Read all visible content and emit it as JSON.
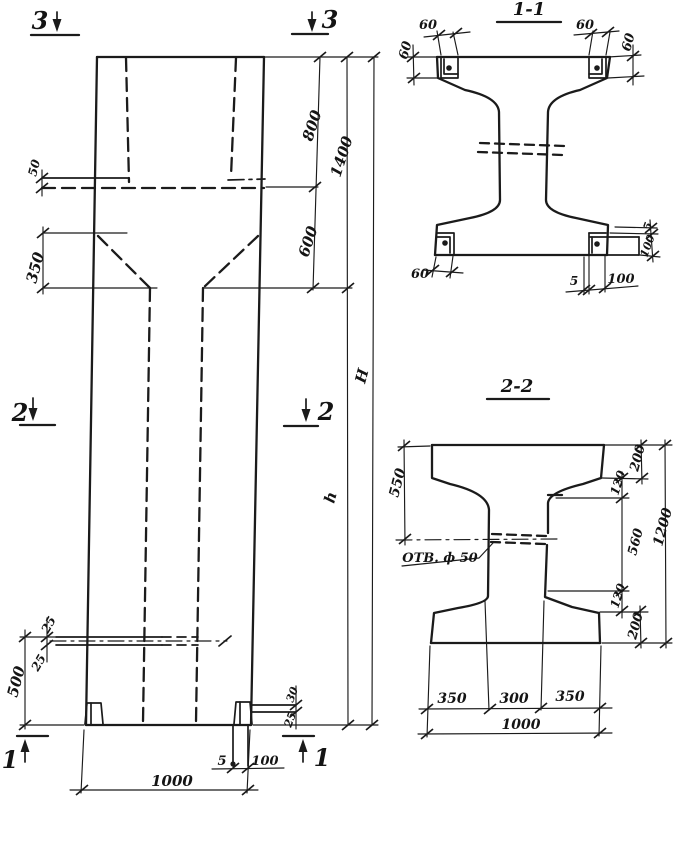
{
  "drawing": {
    "elevation": {
      "markers": {
        "m3_left": "3",
        "m3_right": "3",
        "m2_left": "2",
        "m2_right": "2",
        "m1_left": "1",
        "m1_right": "1"
      },
      "dims": {
        "ledge_50": "50",
        "taper_350": "350",
        "seg_800": "800",
        "total_1400": "1400",
        "seg_600": "600",
        "height_total": "H",
        "height_lower": "h",
        "hole_25_upper": "25",
        "hole_25_lower": "25",
        "bottom_500": "500",
        "plate_30": "30",
        "plate_25": "25",
        "base_5": "5",
        "base_100": "100",
        "width_1000": "1000"
      }
    },
    "section_1_1": {
      "title": "1-1",
      "dims": {
        "top_left_60_h": "60",
        "top_left_60_v": "60",
        "top_right_60_h": "60",
        "top_right_60_v": "60",
        "bottom_left_60": "60",
        "bottom_5": "5",
        "bottom_100": "100",
        "right_5": "5",
        "right_100": "100"
      }
    },
    "section_2_2": {
      "title": "2-2",
      "hole_label": "ОТВ. ф 50",
      "dims": {
        "left_550": "550",
        "top_200": "200",
        "upper_120": "120",
        "mid_560": "560",
        "lower_120": "120",
        "bottom_200": "200",
        "total_1200": "1200",
        "bottom_350_left": "350",
        "bottom_300": "300",
        "bottom_350_right": "350",
        "bottom_1000": "1000"
      }
    }
  }
}
